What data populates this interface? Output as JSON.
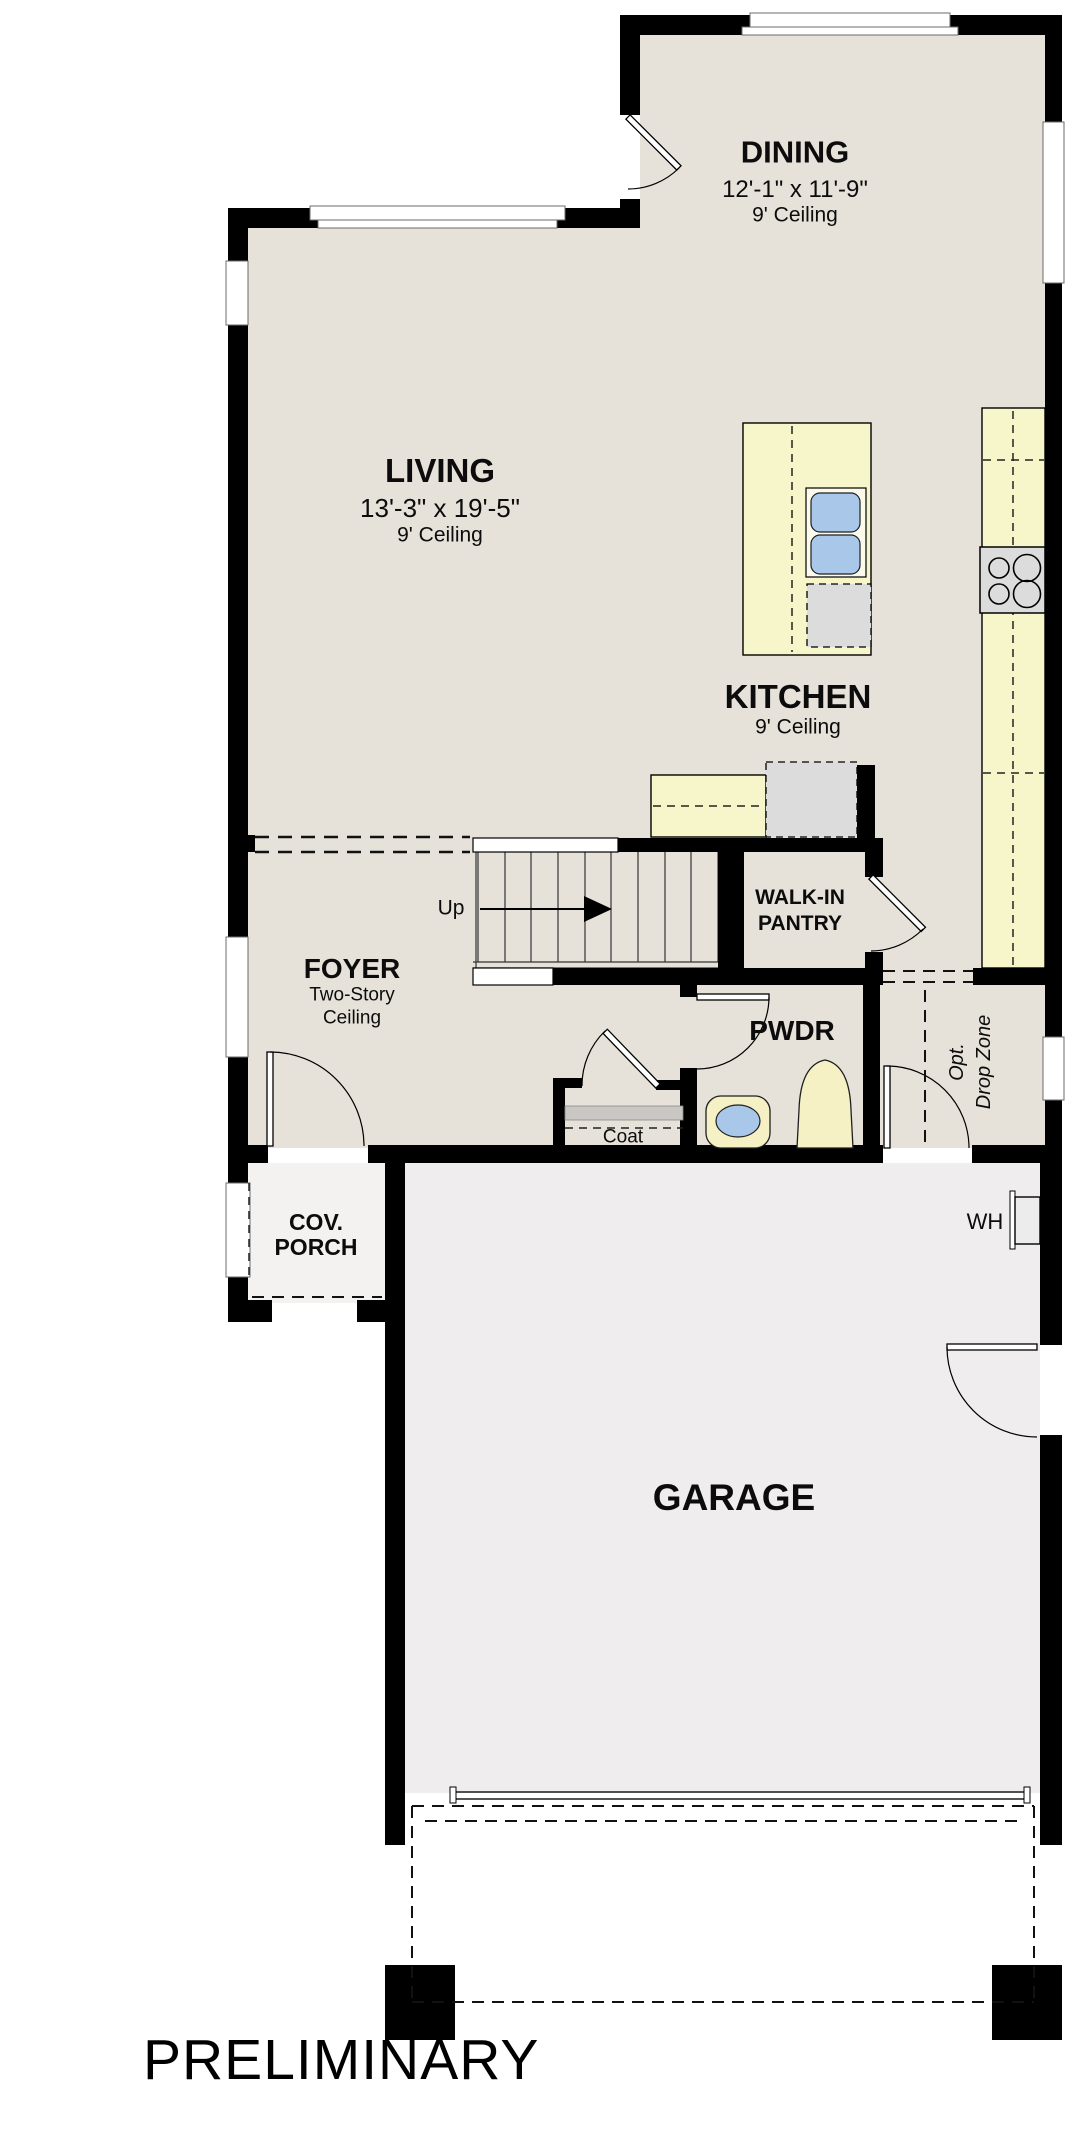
{
  "watermark": "PRELIMINARY",
  "rooms": {
    "dining": {
      "name": "DINING",
      "dims": "12'-1\" x 11'-9\"",
      "ceiling": "9' Ceiling"
    },
    "living": {
      "name": "LIVING",
      "dims": "13'-3\" x 19'-5\"",
      "ceiling": "9' Ceiling"
    },
    "kitchen": {
      "name": "KITCHEN",
      "ceiling": "9' Ceiling"
    },
    "pantry": {
      "line1": "WALK-IN",
      "line2": "PANTRY"
    },
    "foyer": {
      "name": "FOYER",
      "note1": "Two-Story",
      "note2": "Ceiling"
    },
    "powder": {
      "name": "PWDR"
    },
    "coat": {
      "name": "Coat"
    },
    "drop_zone": {
      "line1": "Opt.",
      "line2": "Drop Zone"
    },
    "porch": {
      "line1": "COV.",
      "line2": "PORCH"
    },
    "garage": {
      "name": "GARAGE"
    },
    "stairs": {
      "direction": "Up"
    },
    "water_heater": {
      "abbr": "WH"
    }
  },
  "colors": {
    "floor": "#e6e2da",
    "garage_floor": "#f0edee",
    "porch_floor": "#f3f2f0",
    "counter": "#f7f6cb",
    "appliance": "#dcdcdc",
    "fixture_blue": "#a9c8e9",
    "fixture_cream": "#f5f1c5",
    "wall": "#000000"
  }
}
